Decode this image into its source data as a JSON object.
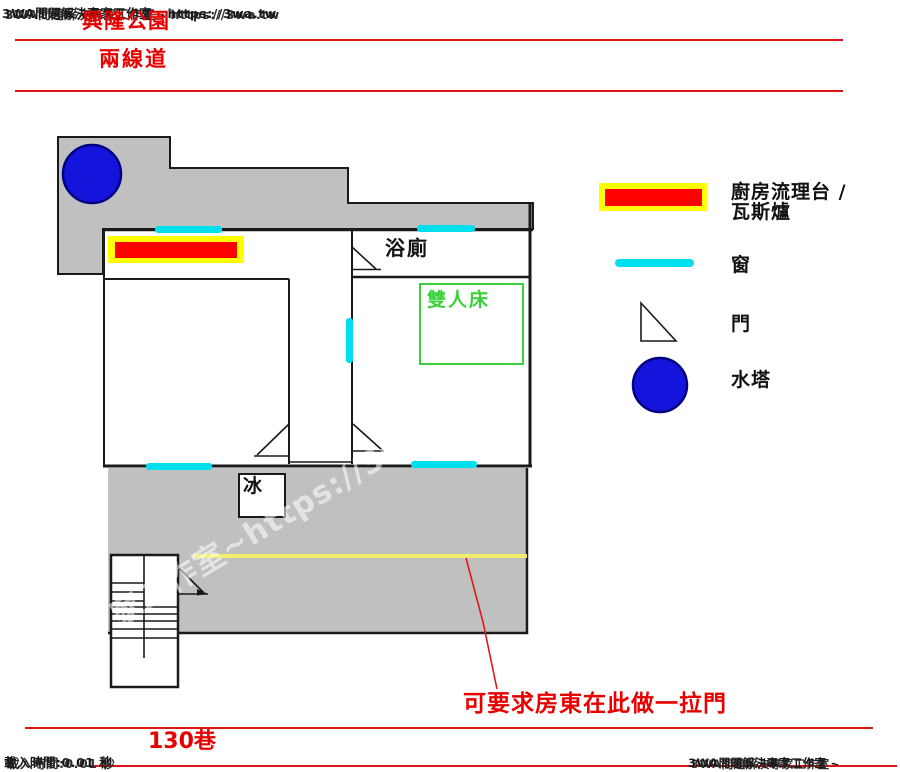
{
  "watermarks": {
    "site_top": "3WA問題解決專家工作室 - https://3wa.tw",
    "site_bottom": "3WA問題解決專家工作室 - https://3wa.tw",
    "load_time": "載入時間:0.01 秒",
    "diagonal": "家工作室~https://3wa.tw"
  },
  "surroundings": {
    "park": "興隆公園",
    "road": "兩線道",
    "lane": "130巷"
  },
  "plan": {
    "bathroom_label": "浴廁",
    "bed_label": "雙人床",
    "fridge_label": "冰",
    "annotation": "可要求房東在此做一拉門"
  },
  "legend": {
    "counter_label_line1": "廚房流理台 /",
    "counter_label_line2": "瓦斯爐",
    "window_label": "窗",
    "door_label": "門",
    "water_tower_label": "水塔"
  },
  "colors": {
    "wall": "#1a1a1a",
    "floor_gray": "#c0c0c0",
    "counter_red": "#ff0000",
    "counter_border_yellow": "#ffff00",
    "window_cyan": "#00dfee",
    "water_tower_blue": "#1414dd",
    "bed_green": "#3ad13a",
    "accent_red": "#e80000",
    "sliding_door_yellow": "#f0ee6a"
  }
}
